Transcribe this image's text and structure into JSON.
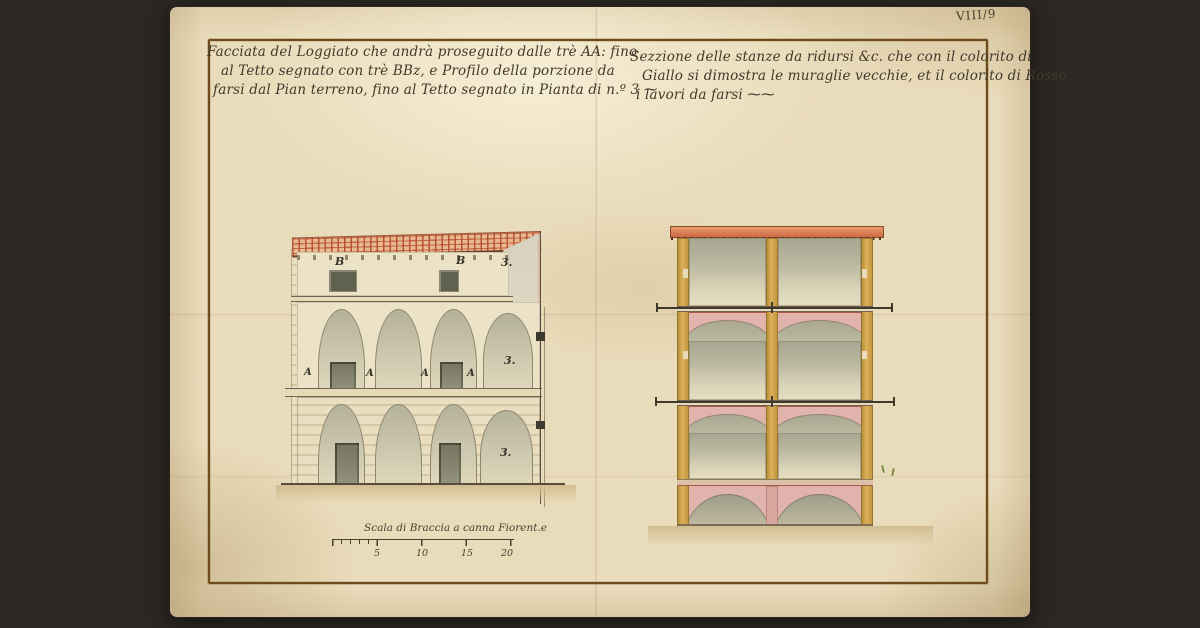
{
  "palette": {
    "background": "#2b2722",
    "parchment": "#e9dcba",
    "frame_brown": "#6d4b1c",
    "ink": "#42382b",
    "roof_orange": "#c8603e",
    "wall_ochre": "#c99c42",
    "vault_gray": "#b3b09a",
    "spandrel_pink": "#e0b3ac",
    "ground_tan": "#d3bf93"
  },
  "inscriptions": {
    "folio": "VIII/9",
    "left_title": [
      "Facciata del Loggiato che andrà proseguito dalle trè AA: fino",
      "al Tetto segnato con trè BBz, e Profilo della porzione da",
      "farsi dal Pian terreno, fino al Tetto segnato in Pianta di n.º 3 ⁓"
    ],
    "right_title": [
      "Sezzione delle stanze da ridursi &c. che con il colorito di",
      "Giallo si dimostra le muraglie vecchie, et il colorito di Rosso",
      "i lavori da farsi ⁓⁓"
    ]
  },
  "left_drawing": {
    "description": "Facade and profile of a three-storey loggia with tiled roof, two arcade levels and attic windows",
    "attic_labels": [
      "B",
      "B"
    ],
    "arcade_labels": [
      "A",
      "A",
      "A",
      "A"
    ],
    "section_labels": [
      "3.",
      "3.",
      "3."
    ]
  },
  "right_drawing": {
    "description": "Section of the rooms: four levels, ochre old walls, pink new work, gray vaults with iron tie rods"
  },
  "scale_bar": {
    "title": "Scala di Braccia a canna Fiorent.e",
    "ticks": [
      "5",
      "10",
      "15",
      "20"
    ]
  }
}
